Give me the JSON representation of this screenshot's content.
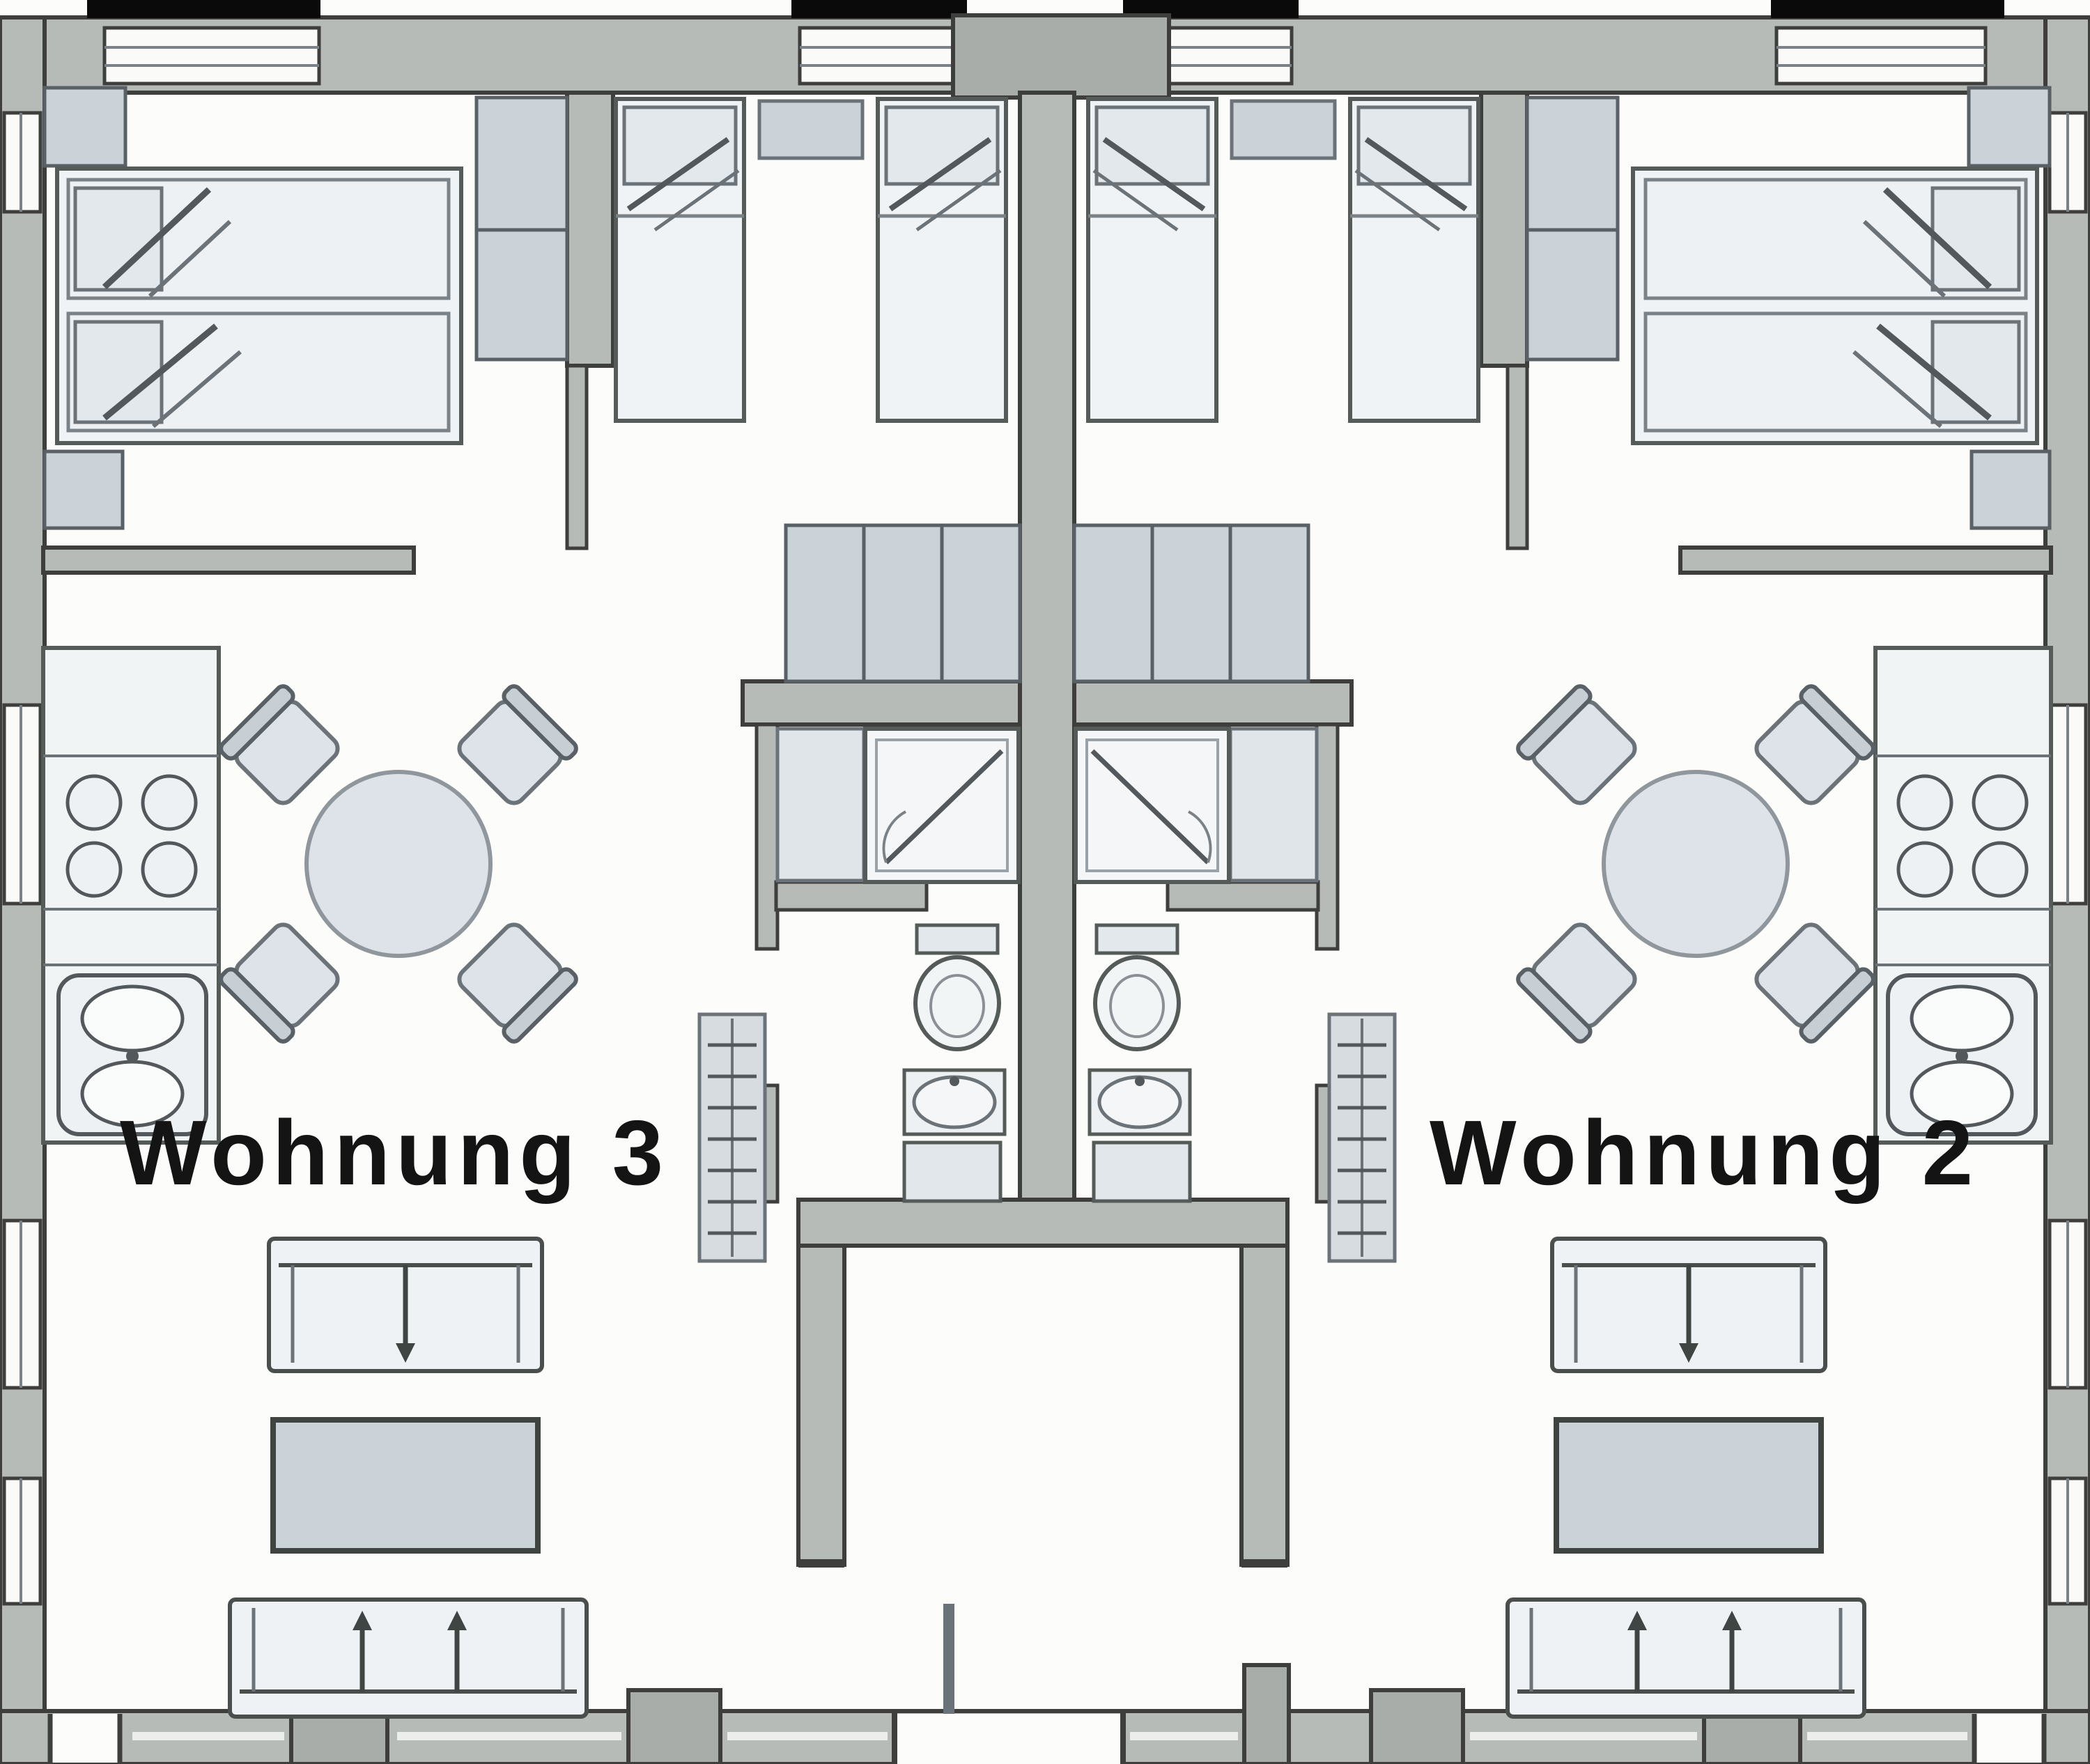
{
  "document": {
    "type": "floor-plan",
    "style": "scanned grayscale architectural drawing, two mirrored apartments"
  },
  "apartments": [
    {
      "id": "wohnung-3",
      "label": "Wohnung 3",
      "side": "left",
      "rooms": [
        "double-bedroom",
        "twin-bedroom",
        "bathroom",
        "open-kitchen-dining-living"
      ],
      "furniture": [
        "double-bed",
        "wardrobe",
        "corner-closet",
        "dresser",
        "twin-bed-a",
        "twin-bed-b",
        "nightstand",
        "built-in-wardrobe-run",
        "washing-machine",
        "shower",
        "wc",
        "washbasin",
        "bath-cabinet",
        "radiator",
        "kitchen-counter",
        "stove-4-burners",
        "double-sink",
        "round-dining-table",
        "4-chairs",
        "two-seat-sofa",
        "coffee-table",
        "three-seat-sofa"
      ]
    },
    {
      "id": "wohnung-2",
      "label": "Wohnung 2",
      "side": "right",
      "rooms": [
        "double-bedroom",
        "twin-bedroom",
        "bathroom",
        "open-kitchen-dining-living"
      ],
      "furniture": [
        "double-bed",
        "wardrobe",
        "corner-closet",
        "dresser",
        "twin-bed-a",
        "twin-bed-b",
        "nightstand",
        "built-in-wardrobe-run",
        "washing-machine",
        "shower",
        "wc",
        "washbasin",
        "bath-cabinet",
        "radiator",
        "kitchen-counter",
        "stove-4-burners",
        "double-sink",
        "round-dining-table",
        "4-chairs",
        "two-seat-sofa",
        "coffee-table",
        "three-seat-sofa"
      ]
    }
  ],
  "colors": {
    "paper": "#fcfcfb",
    "wall_fill": "#b6bbb7",
    "wall_dark_block": "#a8ada9",
    "wall_edge": "#3e3f3c",
    "furniture_light": "#eff2f4",
    "furniture_mid": "#ccd3d8",
    "fixture_fill": "#e3e8ec",
    "outline": "#4a4f4d",
    "label_text": "#141414",
    "top_edge_black": "#0a0a0a"
  }
}
